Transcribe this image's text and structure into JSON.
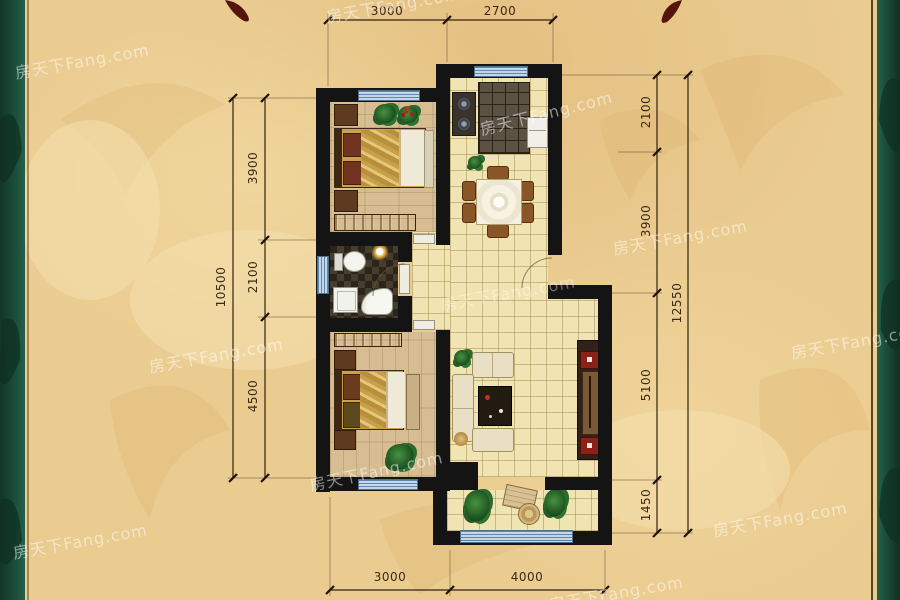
{
  "watermark": {
    "text": "房天下Fang.com"
  },
  "dimensions": {
    "top": [
      {
        "value": "3000"
      },
      {
        "value": "2700"
      }
    ],
    "bottom": [
      {
        "value": "3000"
      },
      {
        "value": "4000"
      }
    ],
    "left_segments": [
      {
        "value": "3900"
      },
      {
        "value": "2100"
      },
      {
        "value": "4500"
      }
    ],
    "left_total": {
      "value": "10500"
    },
    "right_segments": [
      {
        "value": "2100"
      },
      {
        "value": "3900"
      },
      {
        "value": "5100"
      },
      {
        "value": "1450"
      }
    ],
    "right_total": {
      "value": "12550"
    }
  },
  "colors": {
    "background_tan": "#eacb90",
    "side_border_green": "#1d4f3b",
    "wall_black": "#141414",
    "window_blue": "#c3d7e8",
    "dimension_text": "#3b2a16",
    "ornament_maroon": "#54150f"
  }
}
